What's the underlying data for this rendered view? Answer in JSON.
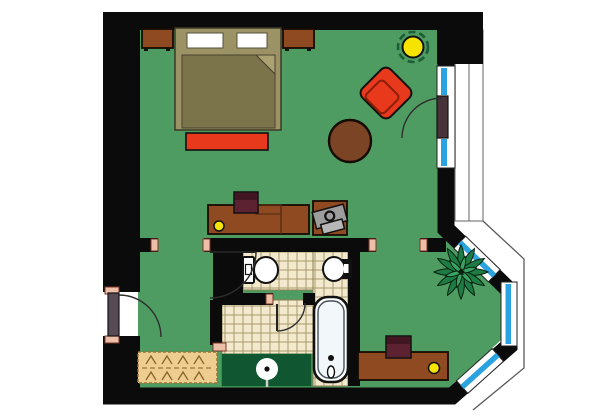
{
  "meta": {
    "type": "floor-plan",
    "view": "top-down",
    "description": "one-room apartment / hotel suite floor plan with bathroom, bay window and balcony"
  },
  "colors": {
    "wall": "#0b0b0b",
    "floor": "#4f9c62",
    "tile": "#f3e9cc",
    "tileline": "#a79a6e",
    "niche": "#0f5631",
    "window_blue": "#2aa3e0",
    "cap": "#eebfa8",
    "capline": "#7a3428",
    "wood": "#8f4a22",
    "table_brown": "#7a4425",
    "accent_red": "#e8391d",
    "bed_frame": "#9b9365",
    "blanket": "#7b744a",
    "blanket_fold": "#aba173",
    "pillow": "#ffffff",
    "chair_maroon": "#5c2231",
    "chair_maroon_dark": "#421523",
    "lamp_yellow": "#f6e400",
    "plant_green": "#1d7c44",
    "plant_light": "#3aa263",
    "gray_item": "#9d9d9d",
    "gray_item_light": "#b7b7b7",
    "door_entry": "#584a55",
    "door_balcony": "#48323a",
    "rug": "#eecd90",
    "rug_line": "#9a7434",
    "white": "#ffffff"
  },
  "rooms": [
    {
      "name": "main-room",
      "floor": "green"
    },
    {
      "name": "bathroom-wc",
      "floor": "tile",
      "fixtures": [
        "toilet",
        "wall-sink"
      ]
    },
    {
      "name": "bathroom-hall",
      "floor": "tile"
    },
    {
      "name": "bath-tub-area",
      "floor": "tile",
      "fixtures": [
        "bathtub"
      ]
    },
    {
      "name": "closet-niche",
      "floor": "dark-green",
      "fixtures": [
        "pedestal-basin"
      ]
    },
    {
      "name": "bay-window-nook",
      "floor": "green"
    },
    {
      "name": "balcony",
      "floor": "white"
    }
  ],
  "furniture": [
    {
      "name": "double-bed"
    },
    {
      "name": "pillow",
      "count": 2
    },
    {
      "name": "nightstand",
      "count": 2
    },
    {
      "name": "bed-bench-red"
    },
    {
      "name": "armchair-red"
    },
    {
      "name": "round-coffee-table"
    },
    {
      "name": "writing-desk-with-lamp"
    },
    {
      "name": "desk-chair",
      "count": 2
    },
    {
      "name": "side-table-with-office-chair"
    },
    {
      "name": "second-desk-with-lamp"
    },
    {
      "name": "potted-plant"
    },
    {
      "name": "rug"
    },
    {
      "name": "ceiling-lamp-yellow"
    }
  ],
  "doors": [
    {
      "name": "entry-door",
      "wall": "left"
    },
    {
      "name": "balcony-door",
      "wall": "right"
    },
    {
      "name": "bathroom-door",
      "count": 2
    }
  ]
}
